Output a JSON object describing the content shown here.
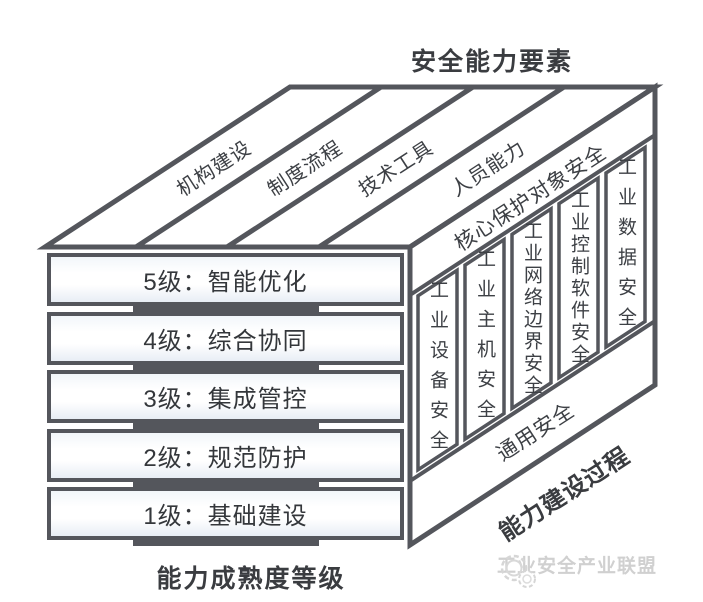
{
  "title": "安全能力要素",
  "top_face": {
    "labels": [
      "机构建设",
      "制度流程",
      "技术工具",
      "人员能力"
    ]
  },
  "maturity_levels": [
    "5级：智能优化",
    "4级：综合协同",
    "3级：集成管控",
    "2级：规范防护",
    "1级：基础建设"
  ],
  "right_face": {
    "header": "核心保护对象安全",
    "columns": [
      "工业设备安全",
      "工业主机安全",
      "工业网络边界安全",
      "工业控制软件安全",
      "工业数据安全"
    ],
    "footer": "通用安全"
  },
  "axes": {
    "bottom": "能力成熟度等级",
    "right": "能力建设过程"
  },
  "logo": {
    "icon": "gear-icon",
    "text": "工业安全产业联盟"
  },
  "colors": {
    "line": "#54565c",
    "text": "#3d4045",
    "logo": "#d0d0d0",
    "box_tint": "#e8eef5"
  }
}
